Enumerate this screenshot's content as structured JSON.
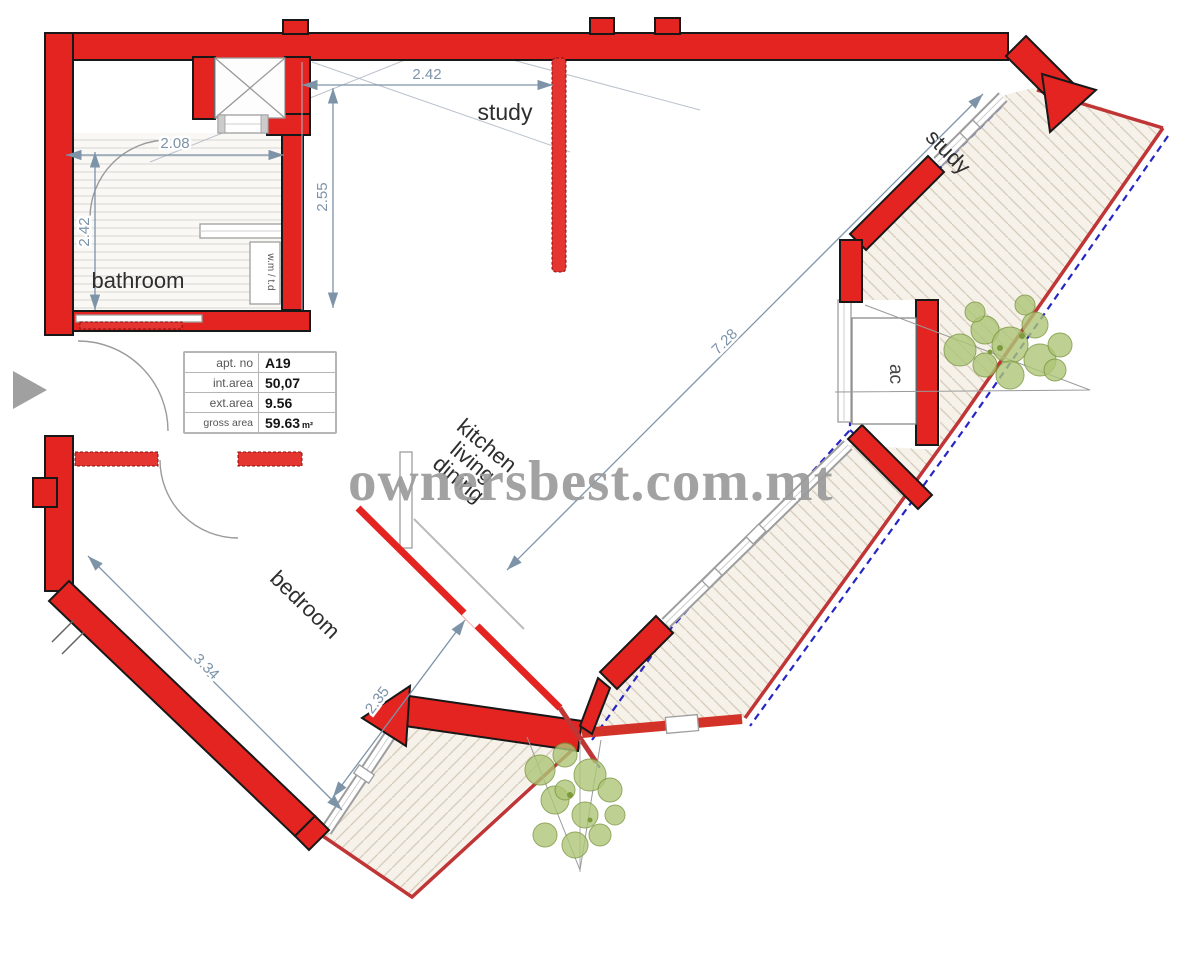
{
  "plan": {
    "watermark": "ownersbest.com.mt",
    "rooms": {
      "bathroom": "bathroom",
      "study_top": "study",
      "study_right": "study",
      "bedroom": "bedroom",
      "kitchen_lines": [
        "kitchen",
        "living",
        "dining"
      ],
      "ac": "ac",
      "utility": "w.m / t.d"
    },
    "dimensions": {
      "study_width": "2.42",
      "study_depth": "2.55",
      "bathroom_width": "2.08",
      "bathroom_depth": "2.42",
      "living_diagonal": "7.28",
      "bedroom_length": "3.34",
      "bedroom_width": "2.35"
    },
    "info_table": {
      "rows": [
        {
          "label": "apt. no",
          "value": "A19",
          "unit": ""
        },
        {
          "label": "int.area",
          "value": "50,07",
          "unit": ""
        },
        {
          "label": "ext.area",
          "value": "9.56",
          "unit": ""
        },
        {
          "label": "gross area",
          "value": "59.63",
          "unit": "m²"
        }
      ]
    },
    "colors": {
      "wall": "#e32420",
      "dimension": "#7d93a8",
      "terrace_edge": "#c03535",
      "boundary_dash": "#2626c4",
      "plant": "#aec677",
      "watermark": "#9b9b9b"
    }
  }
}
